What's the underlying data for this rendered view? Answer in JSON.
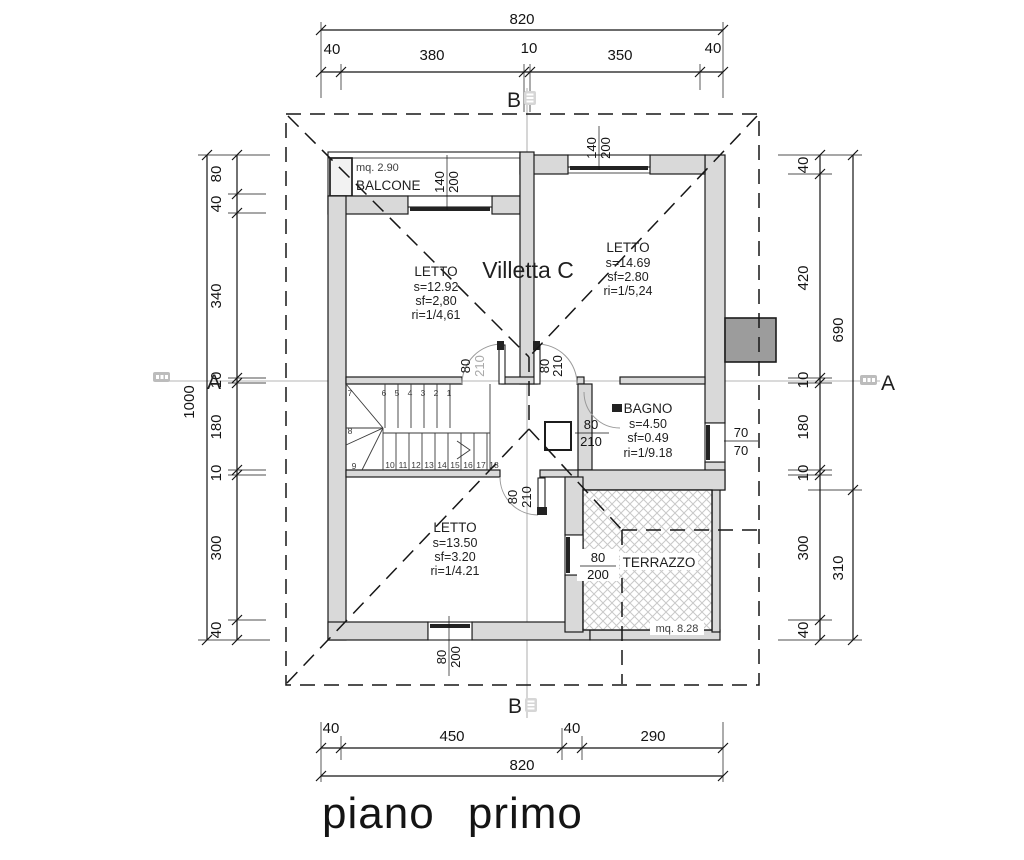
{
  "title": "piano primo",
  "villa_label": "Villetta C",
  "section_markers": {
    "a": "A",
    "b": "B"
  },
  "rooms": {
    "balcone": {
      "name": "BALCONE",
      "area": "mq. 2.90"
    },
    "letto_nw": {
      "name": "LETTO",
      "s": "s=12.92",
      "sf": "sf=2,80",
      "ri": "ri=1/4,61"
    },
    "letto_ne": {
      "name": "LETTO",
      "s": "s=14.69",
      "sf": "sf=2.80",
      "ri": "ri=1/5,24"
    },
    "letto_sw": {
      "name": "LETTO",
      "s": "s=13.50",
      "sf": "sf=3.20",
      "ri": "ri=1/4.21"
    },
    "bagno": {
      "name": "BAGNO",
      "s": "s=4.50",
      "sf": "sf=0.49",
      "ri": "ri=1/9.18"
    },
    "terrazzo": {
      "name": "TERRAZZO",
      "area": "mq. 8.28"
    }
  },
  "openings": {
    "balcone_door_w": "140",
    "balcone_door_h": "200",
    "ne_window_w": "140",
    "ne_window_h": "200",
    "door_nw_w": "80",
    "door_nw_h": "210",
    "door_ne_w": "80",
    "door_ne_h": "210",
    "door_bagno_w": "80",
    "door_bagno_h": "210",
    "door_sw_w": "80",
    "door_sw_h": "210",
    "bagno_window_w": "70",
    "bagno_window_h": "70",
    "sw_window_w": "80",
    "sw_window_h": "200",
    "terrazzo_window_w": "80",
    "terrazzo_window_h": "200"
  },
  "dimensions": {
    "top": {
      "total": "820",
      "segments": [
        "40",
        "380",
        "10",
        "350",
        "40"
      ]
    },
    "bottom": {
      "total": "820",
      "segments": [
        "40",
        "450",
        "40",
        "290"
      ]
    },
    "left": {
      "total": "1000",
      "segments": [
        "80",
        "40",
        "340",
        "10",
        "180",
        "10",
        "300",
        "40"
      ]
    },
    "right": {
      "upper": "690",
      "lower": "310",
      "segments": [
        "40",
        "420",
        "10",
        "180",
        "10",
        "300",
        "40"
      ]
    }
  },
  "stairs": {
    "top": [
      "7",
      "6",
      "5",
      "4",
      "3",
      "2",
      "1"
    ],
    "mid": [
      "8",
      "9"
    ],
    "bottom": [
      "10",
      "11",
      "12",
      "13",
      "14",
      "15",
      "16",
      "17",
      "18"
    ]
  }
}
